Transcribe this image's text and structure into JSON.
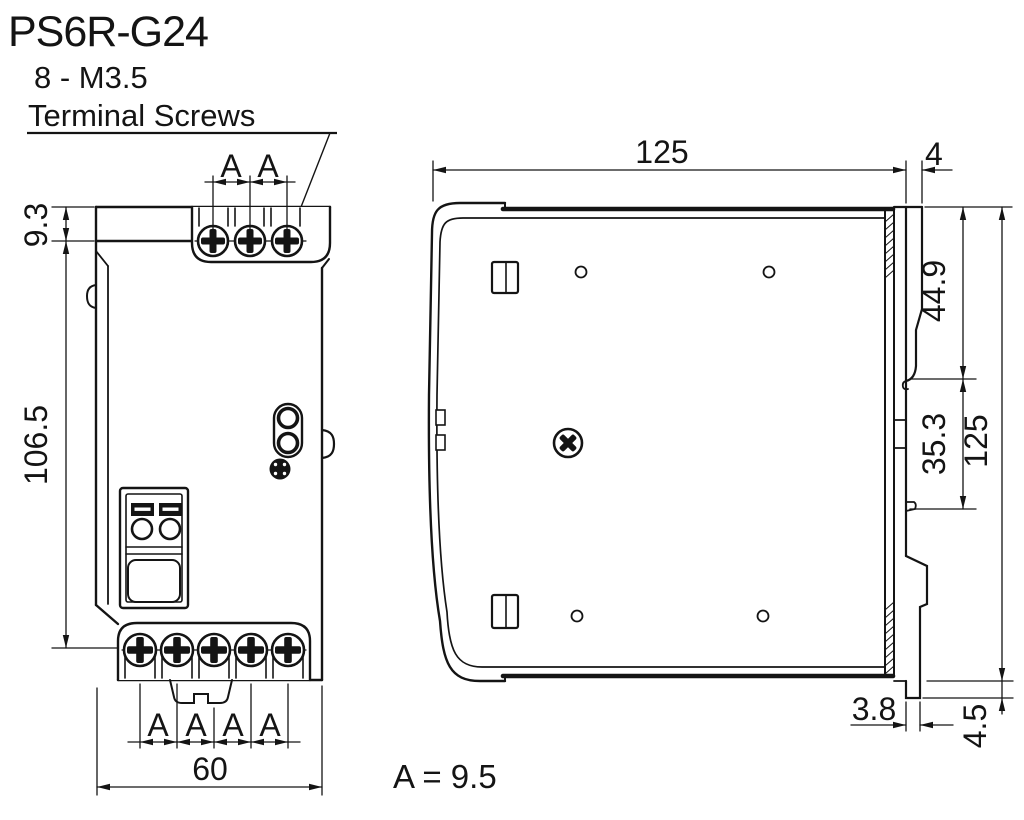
{
  "drawing_title": "PS6R-G24",
  "callout": {
    "line1": "8 - M3.5",
    "line2": "Terminal Screws"
  },
  "front_view": {
    "dim_top_screw_offset": "9.3",
    "dim_body_height": "106.5",
    "dim_overall_width": "60",
    "top_pitch_labels": [
      "A",
      "A"
    ],
    "bottom_pitch_labels": [
      "A",
      "A",
      "A",
      "A"
    ]
  },
  "side_view": {
    "dim_overall_depth": "125",
    "dim_din_clip_depth": "4",
    "dim_clip_upper": "44.9",
    "dim_clip_lower": "35.3",
    "dim_overall_height": "125",
    "dim_foot_depth": "3.8",
    "dim_foot_height": "4.5"
  },
  "note": {
    "pitch_equation": "A = 9.5"
  },
  "colors": {
    "line": "#141414",
    "background": "#ffffff"
  }
}
